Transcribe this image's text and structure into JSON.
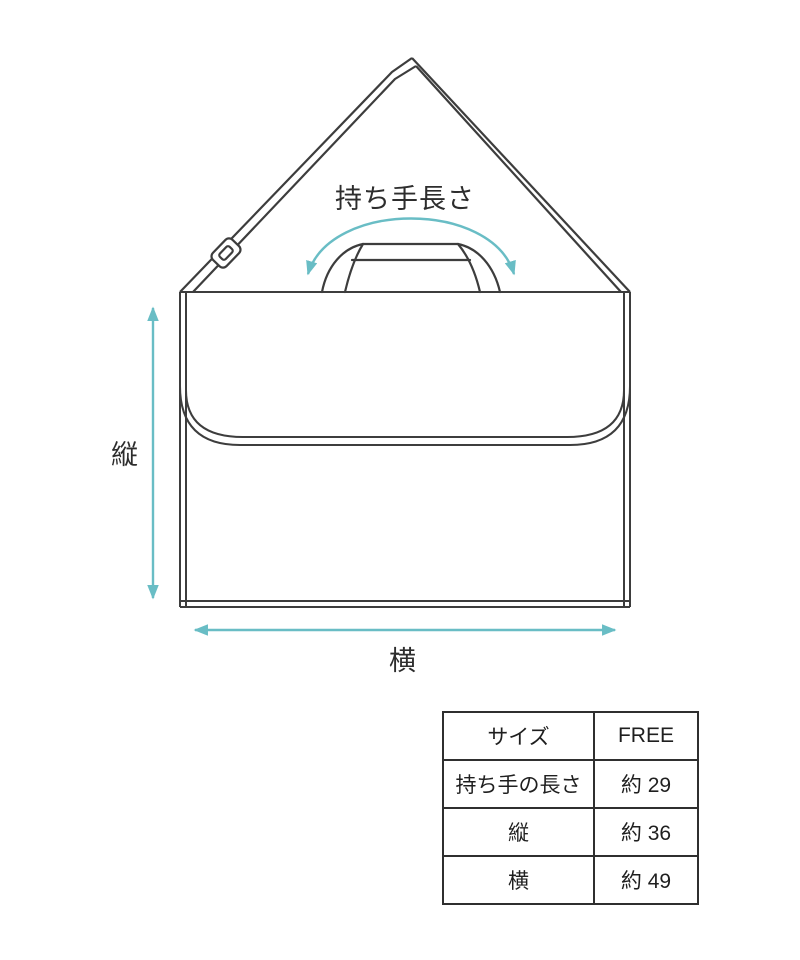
{
  "diagram": {
    "handle_length_label": "持ち手長さ",
    "height_label": "縦",
    "width_label": "横",
    "accent_color": "#69bdc5",
    "line_color": "#3d3d3d"
  },
  "size_table": {
    "header": {
      "label": "サイズ",
      "value": "FREE"
    },
    "rows": [
      {
        "label": "持ち手の長さ",
        "value": "約 29"
      },
      {
        "label": "縦",
        "value": "約 36"
      },
      {
        "label": "横",
        "value": "約 49"
      }
    ]
  }
}
